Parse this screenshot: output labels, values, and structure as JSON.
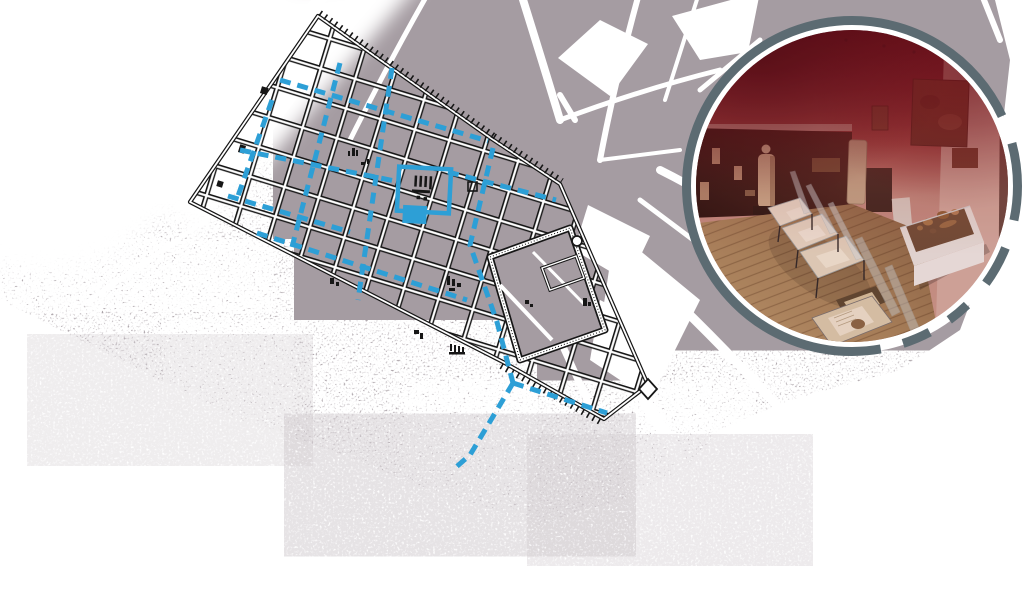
{
  "figure": {
    "kind": "archaeological-site-figure",
    "left_panel": "ancient-city-plan-over-modern-street-map",
    "right_panel": "museum-gallery-photo-in-dashed-ring"
  },
  "colors": {
    "page_bg": "#ffffff",
    "map_gray": "#a59ca2",
    "street_white": "#ffffff",
    "plan_line": "#161616",
    "excavation_blue": "#2d9fd6",
    "ring_slate": "#5c6b72",
    "photo_red_top": "#571722",
    "photo_wall_pink": "#c59287",
    "photo_floor_wood": "#a9895f"
  },
  "map": {
    "city_outline": "318,16 492,139 560,184 648,385 604,419 503,362 190,202",
    "wall_ticks": [
      "320,13 494,136",
      "494,136 562,181",
      "501,366 602,423"
    ],
    "citadel_outer": "490,257 570,228 605,330 520,360",
    "citadel_keep": "542,268 576,256 584,278 550,290",
    "forum": {
      "x": 398,
      "y": 168,
      "w": 52,
      "h": 44
    },
    "blue_streets": [
      "280,80 488,141",
      "240,150 395,181",
      "448,172 556,200",
      "228,196 350,232",
      "257,233 467,300",
      "272,100 238,196",
      "340,63 292,247",
      "392,68 358,300",
      "493,148 470,245 497,322 513,383",
      "513,383 607,413",
      "513,383 470,455 455,468"
    ]
  },
  "inset": {
    "cx": 852,
    "cy": 186,
    "outer_r": 170,
    "ring_width": 9,
    "photo_r": 156,
    "ring_dash": "12 10 14 10 8 8 10 8 255 10 15"
  }
}
